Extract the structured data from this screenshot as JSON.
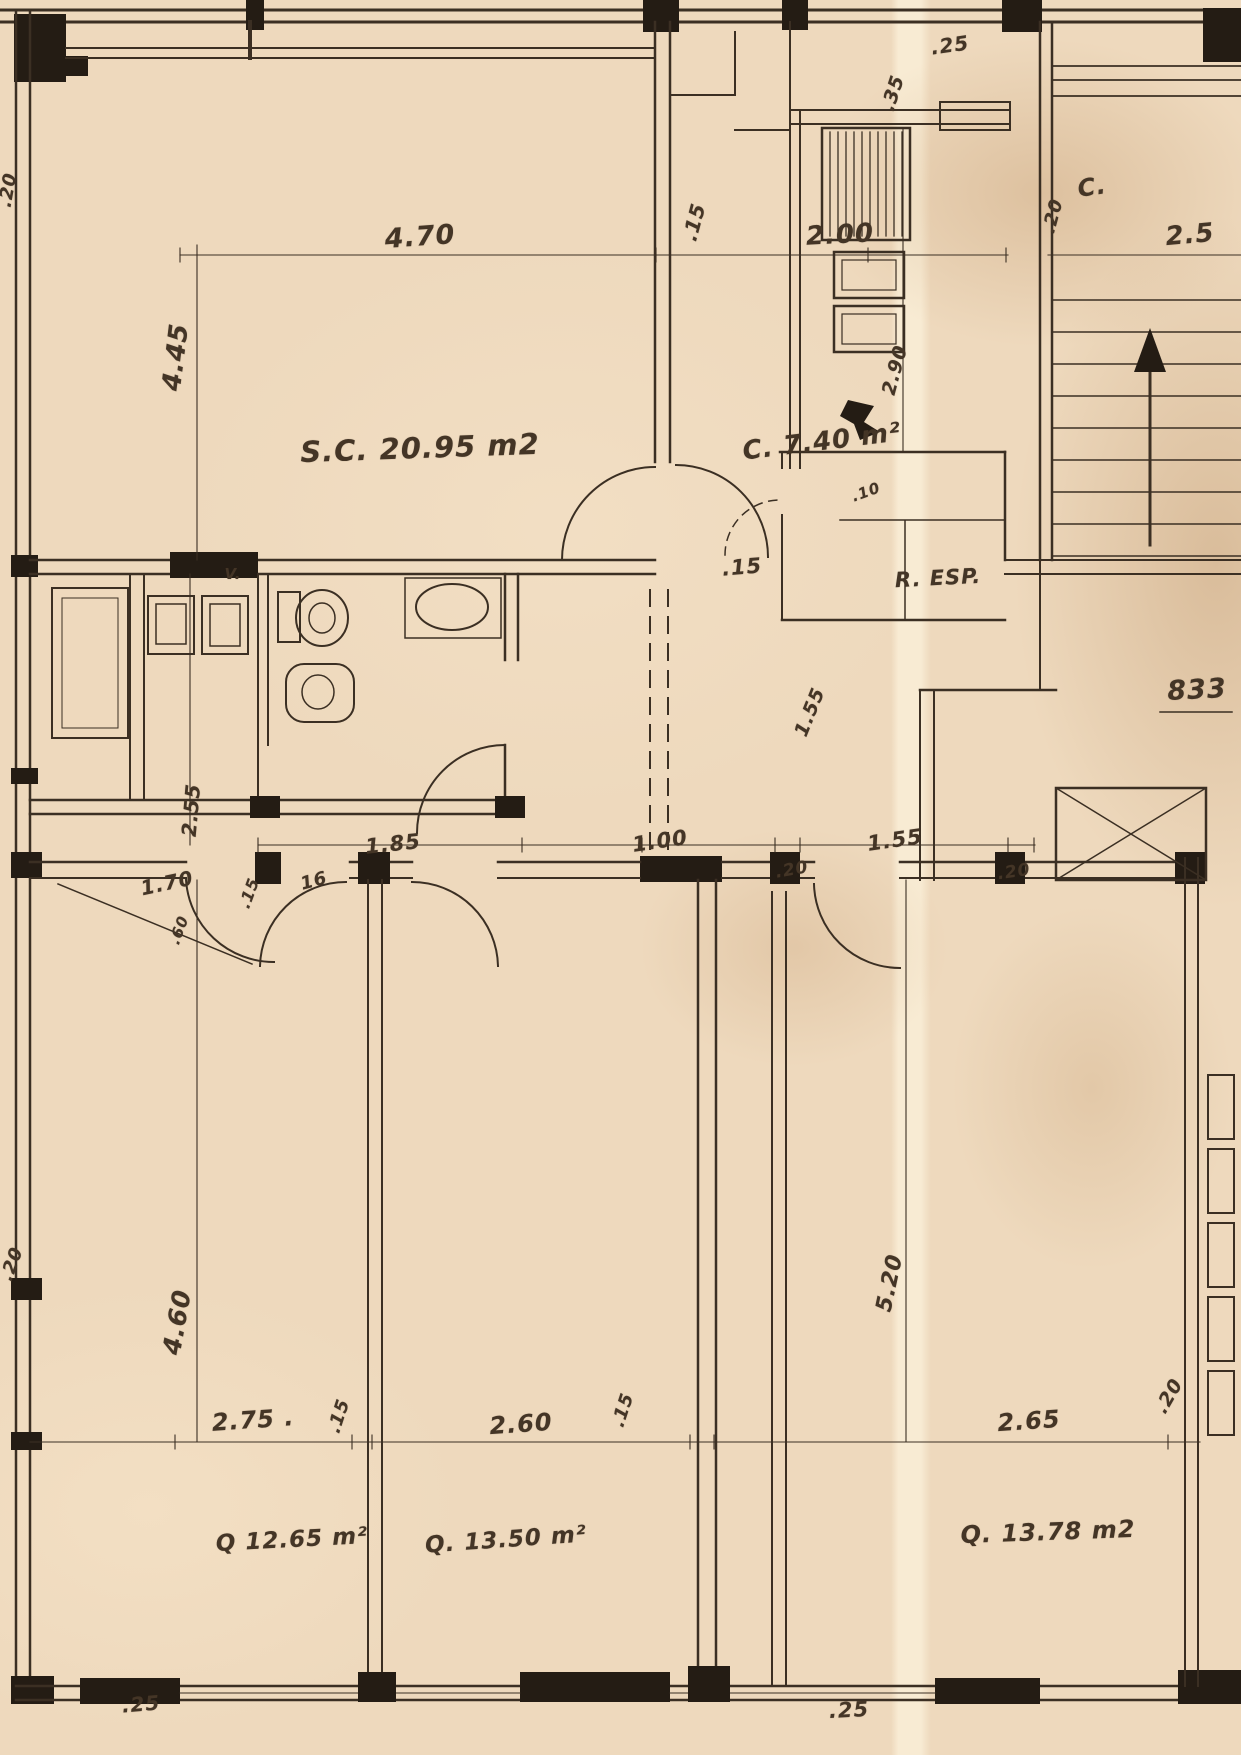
{
  "colors": {
    "paper": "#eed9bd",
    "ink": "#3b2f23"
  },
  "plan": {
    "rooms": {
      "living": "S.C. 20.95 m2",
      "kitchen": "C. 7.40 m²",
      "pantry": "R. ESP.",
      "hall_c": "C.",
      "vent": "V.",
      "bedroom_1": "Q 12.65 m²",
      "bedroom_2": "Q. 13.50 m²",
      "bedroom_3": "Q. 13.78 m2"
    },
    "dimensions": {
      "top_470": "4.70",
      "top_15": ".15",
      "top_200": "2.00",
      "top_25": ".25",
      "top_35": ".35",
      "right_25": "2.5",
      "right_20": ".20",
      "left_445": "4.45",
      "kitchen_290": "2.90",
      "kitchen_10": ".10",
      "center_15": ".15",
      "ref_833": "833",
      "hall_155_rot": "1.55",
      "mid_185": "1.85",
      "mid_100": "1.00",
      "mid_20a": ".20",
      "mid_155": "1.55",
      "mid_20b": ".20",
      "left_255": "2.55",
      "left_170": "1.70",
      "left_15": ".15",
      "left_16": "16",
      "left_60": ".60",
      "edge_20_top": ".20",
      "edge_20_bottom": ".20",
      "left_460": "4.60",
      "right_520": "5.20",
      "bot_275": "2.75 .",
      "bot_15a": ".15",
      "bot_260": "2.60",
      "bot_15b": ".15",
      "bot_265": "2.65",
      "bot_20": ".20",
      "bottom_25_left": ".25",
      "bottom_25_right": ".25"
    }
  }
}
